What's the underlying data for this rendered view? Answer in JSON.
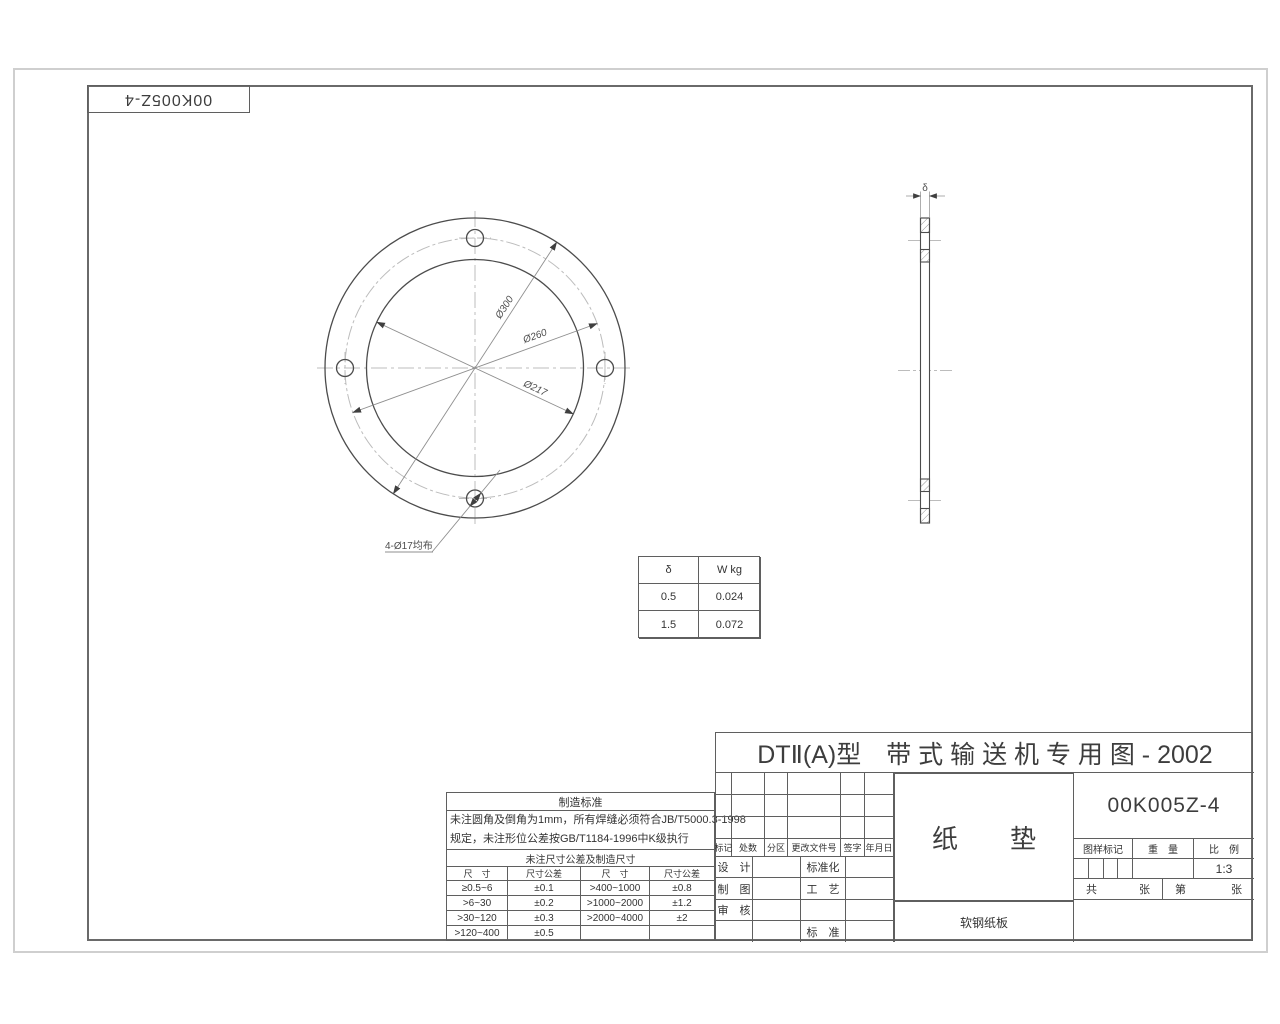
{
  "page": {
    "corner_label": "00K005Z-4"
  },
  "colors": {
    "ink": "#4c4c4c",
    "dim_line": "#8f8f8f",
    "centerline": "#bcbcbc",
    "frame": "#6a6a6a"
  },
  "front_view": {
    "dim_outer": "Ø300",
    "dim_bolt_circle": "Ø260",
    "dim_inner": "Ø217",
    "holes_note": "4-Ø17均布"
  },
  "side_view": {
    "thickness_label": "δ"
  },
  "weight_table": {
    "headers": [
      "δ",
      "W kg"
    ],
    "rows": [
      [
        "0.5",
        "0.024"
      ],
      [
        "1.5",
        "0.072"
      ]
    ]
  },
  "standards": {
    "title": "制造标准",
    "line1": "未注圆角及倒角为1mm，所有焊缝必须符合JB/T5000.3-1998",
    "line2": "规定，未注形位公差按GB/T1184-1996中K级执行",
    "tol_title": "未注尺寸公差及制造尺寸",
    "col_headers": [
      "尺　寸",
      "尺寸公差",
      "尺　寸",
      "尺寸公差"
    ],
    "rows": [
      [
        "≥0.5~6",
        "±0.1",
        ">400~1000",
        "±0.8"
      ],
      [
        ">6~30",
        "±0.2",
        ">1000~2000",
        "±1.2"
      ],
      [
        ">30~120",
        "±0.3",
        ">2000~4000",
        "±2"
      ],
      [
        ">120~400",
        "±0.5",
        "",
        ""
      ]
    ]
  },
  "title_block": {
    "title": "DTⅡ(A)型　带 式 输 送 机 专 用 图 - 2002",
    "revision_headers": [
      "标记",
      "处数",
      "分区",
      "更改文件号",
      "签字",
      "年月日"
    ],
    "sig_rows": [
      {
        "left": "设　计",
        "right": "标准化"
      },
      {
        "left": "制　图",
        "right": "工　艺"
      },
      {
        "left": "审　核",
        "right": ""
      },
      {
        "left": "",
        "right": "标　准"
      }
    ],
    "part_name": "纸　　垫",
    "material": "软钢纸板",
    "drawing_no": "00K005Z-4",
    "labels": {
      "mark": "图样标记",
      "weight": "重　量",
      "scale": "比　例"
    },
    "scale_value": "1:3",
    "sheet": {
      "total": "共",
      "total_unit": "张",
      "no": "第",
      "no_unit": "张"
    }
  }
}
